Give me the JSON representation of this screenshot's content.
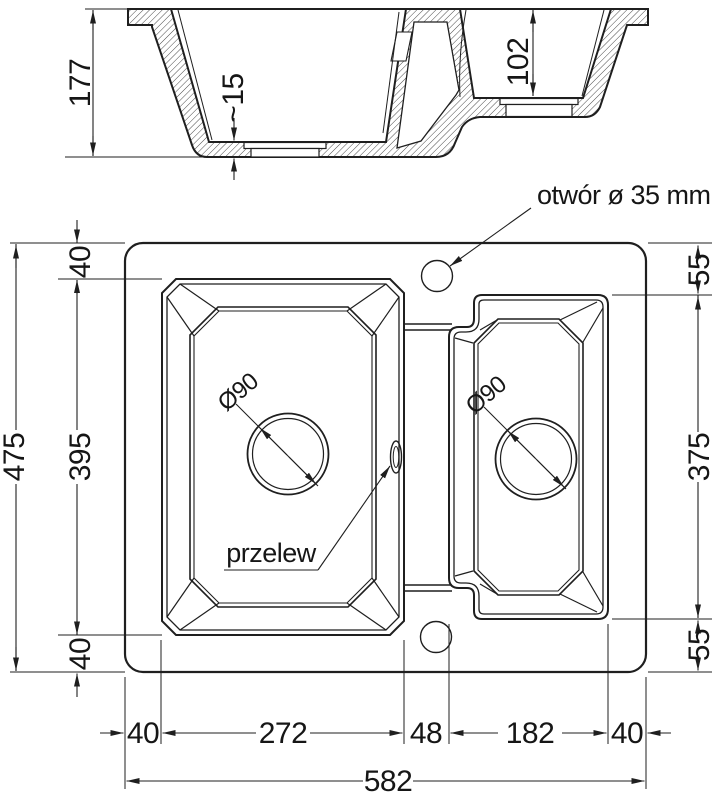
{
  "section_view": {
    "overall_depth": "177",
    "bottom_thickness": "~15",
    "small_bowl_depth": "102"
  },
  "plan_view": {
    "tap_hole_label": "otwór ø 35 mm",
    "overflow_label": "przelew",
    "left_bowl_drain": "Ø90",
    "right_bowl_drain": "Ø90",
    "left_chain": {
      "overall": "475",
      "top": "40",
      "bowl": "395",
      "bottom": "40"
    },
    "right_chain": {
      "top": "55",
      "bowl": "375",
      "bottom": "55"
    },
    "width_chain": {
      "left": "40",
      "left_bowl": "272",
      "divider": "48",
      "right_bowl": "182",
      "right": "40",
      "overall": "582"
    }
  },
  "colors": {
    "line": "#1f1f1f",
    "background": "#ffffff"
  }
}
